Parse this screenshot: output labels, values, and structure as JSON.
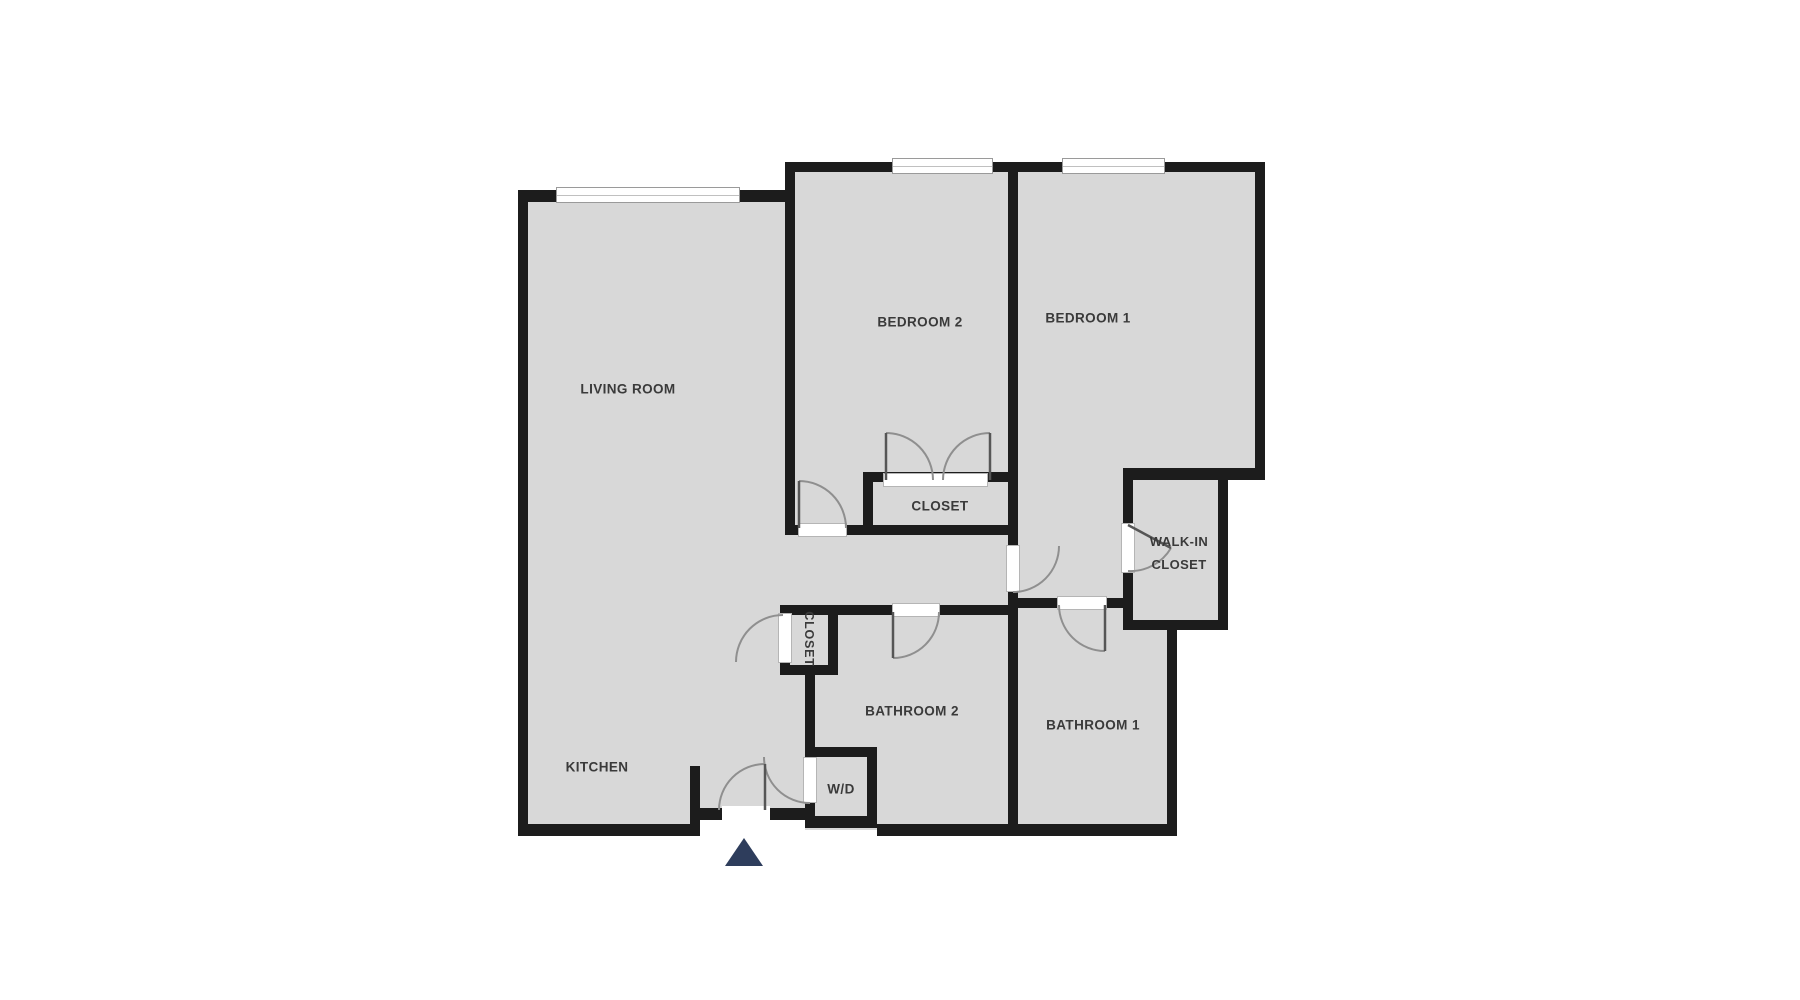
{
  "floor_plan": {
    "rooms": {
      "living_room": {
        "label": "LIVING ROOM"
      },
      "kitchen": {
        "label": "KITCHEN"
      },
      "bedroom_2": {
        "label": "BEDROOM 2"
      },
      "bedroom_1": {
        "label": "BEDROOM 1"
      },
      "bedroom_2_closet": {
        "label": "CLOSET"
      },
      "walk_in_closet": {
        "label": "WALK-IN CLOSET"
      },
      "hall_closet": {
        "label": "CLOSET"
      },
      "bathroom_2": {
        "label": "BATHROOM 2"
      },
      "bathroom_1": {
        "label": "BATHROOM 1"
      },
      "laundry": {
        "label": "W/D"
      }
    },
    "colors": {
      "background": "#ffffff",
      "floor": "#d8d8d8",
      "wall": "#1c1c1c",
      "door_arc": "#8f8f8f",
      "door_leaf": "#565656",
      "opening_outline": "#b5b5b5",
      "window_outline": "#9a9a9a",
      "label_text": "#3a3a3a",
      "entry_arrow": "#2e3d5c"
    }
  }
}
